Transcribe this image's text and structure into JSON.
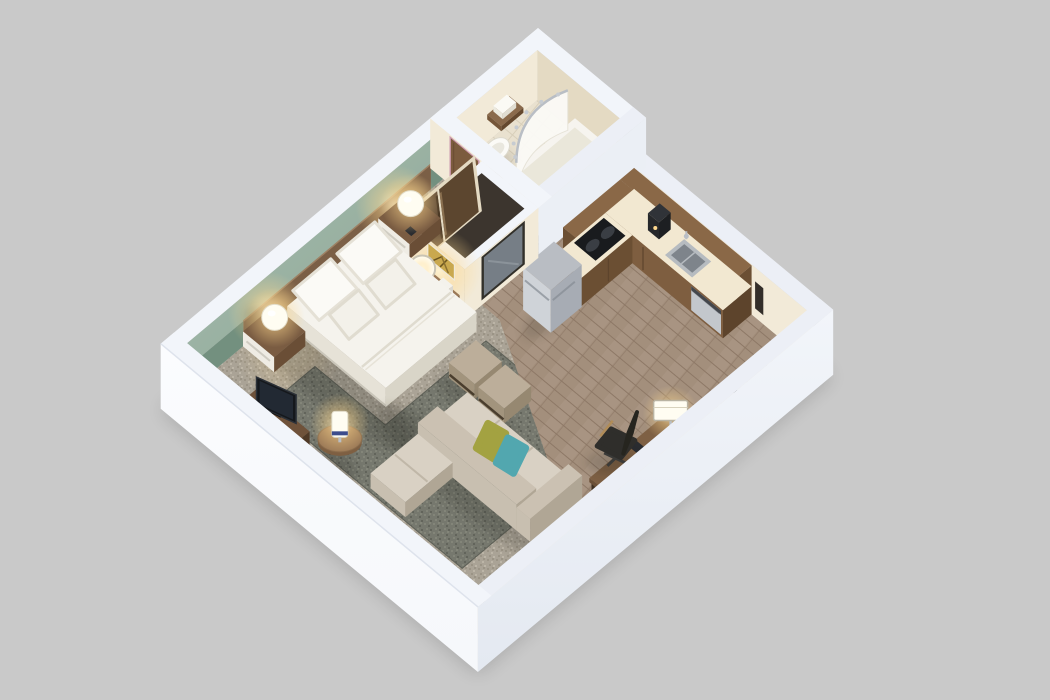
{
  "title": "3D cutaway floor plan render of a hotel studio suite",
  "background": "#c9c9c9",
  "projection": {
    "ox": 538,
    "oy": 78,
    "ux": 23.5,
    "uy": 19.5,
    "vx": -24.5,
    "vy": 20.5,
    "hz": 50
  },
  "colors": {
    "bg": "#c9c9c9",
    "wallTop": "#eceff6",
    "wallTopBright": "#f2f5fa",
    "outerSW": "#f6f8fb",
    "outerSE": "#e4e9f1",
    "outerDark": "#d8deea",
    "cream": "#f2ead8",
    "creamShade": "#e4dac3",
    "green": "#8ba396",
    "greenLight": "#a9c0af",
    "greenDark": "#73907f",
    "headboardWood": "#7b5f46",
    "headboardDark": "#5f4733",
    "carpet": "#aaa396",
    "carpetDotA": "#9b9486",
    "carpetDotB": "#bcb5a7",
    "rug": "#76786e",
    "rugDotA": "#838579",
    "rugDotB": "#62645b",
    "woodFloor": "#a38f7c",
    "woodFloorDark": "#8d7866",
    "tile": "#e9e1cf",
    "counter": "#f2e8d1",
    "cabinet": "#7e5e40",
    "cabinetDark": "#6b4f33",
    "cabinetSide": "#5d442c",
    "glassPanel": "#eae5d8",
    "steel": "#c3c7cc",
    "steelLight": "#cfd3d8",
    "steelDark": "#a7acb4",
    "black": "#1e2023",
    "white": "#f6f4ef",
    "bedTop": "#f5f3ed",
    "bedSide": "#e6e2d7",
    "bedFoot": "#d9d5c8",
    "pillowWhite": "#fbfaf6",
    "sofa": "#c8bfb0",
    "sofaSeat": "#d9d1c4",
    "sofaDark": "#b0a695",
    "ottoman": "#bcae9a",
    "ottomanSide": "#a2947d",
    "pillowOlive": "#a3a241",
    "pillowTeal": "#52a7af",
    "woodMid": "#8a6a4c",
    "woodTable": "#9a7856",
    "doorWhite": "#f2ecdd",
    "doorWood": "#7b5b3e",
    "closetDoor": "#5c462f",
    "artGold": "#c9a84e",
    "mirrorGlass": "#767e86",
    "glowWarm": "#ffd98f",
    "lampWhite": "#fffdf2",
    "chrome": "#b9bec5"
  },
  "rooms": [
    "bathroom",
    "closet",
    "kitchen",
    "entry",
    "bedroom",
    "living-area"
  ],
  "objects": [
    "bathtub-shower",
    "shower-curtain",
    "shower-rod",
    "toilet",
    "towel-shelf",
    "bathroom-door",
    "closet-sliding-doors",
    "wall-mirror",
    "wall-art",
    "vanity-shelf",
    "vanity-mirror",
    "tissue-box",
    "kitchen-upper-cabinets",
    "microwave",
    "kitchen-counter",
    "cooktop",
    "sink",
    "coffee-maker",
    "dishwasher",
    "refrigerator",
    "entry-door",
    "door-closer",
    "light-switch",
    "ironing-board-holder",
    "king-bed",
    "bed-pillows",
    "nightstand-north",
    "nightstand-south",
    "sphere-lamp-north",
    "sphere-lamp-south",
    "phone",
    "tv",
    "tv-console",
    "ptac-unit",
    "sectional-sofa",
    "chaise",
    "accent-pillow-olive",
    "accent-pillow-teal",
    "ottoman-left",
    "ottoman-right",
    "round-side-table",
    "cylinder-lamp",
    "desk",
    "desk-chair",
    "desk-lamp",
    "area-rug",
    "bedroom-carpet",
    "wood-floor",
    "tile-floor",
    "green-accent-wall",
    "headboard-panel"
  ]
}
